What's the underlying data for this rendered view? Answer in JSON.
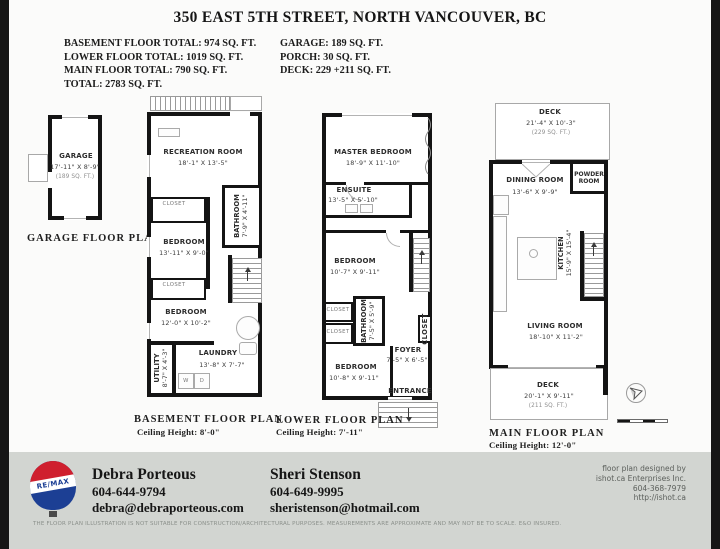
{
  "header": {
    "title": "350 EAST 5TH STREET, NORTH VANCOUVER, BC",
    "summary_left": [
      "BASEMENT FLOOR TOTAL: 974 SQ. FT.",
      "LOWER FLOOR TOTAL: 1019 SQ. FT.",
      "MAIN FLOOR TOTAL: 790 SQ. FT.",
      "TOTAL: 2783 SQ. FT."
    ],
    "summary_right": [
      "GARAGE: 189 SQ. FT.",
      "PORCH: 30 SQ. FT.",
      "DECK: 229 +211 SQ. FT."
    ]
  },
  "garage_plan": {
    "caption": "GARAGE FLOOR PLAN",
    "room": {
      "name": "GARAGE",
      "dims": "17'-11\" X 8'-9\"",
      "area": "(189 SQ. FT.)"
    }
  },
  "basement_plan": {
    "caption": "BASEMENT FLOOR PLAN",
    "ceiling": "Ceiling Height: 8'-0\"",
    "rooms": {
      "recreation": {
        "name": "RECREATION ROOM",
        "dims": "18'-1\" X 13'-5\""
      },
      "bathroom": {
        "name": "BATHROOM",
        "dims": "7'-9\" X 4'-11\""
      },
      "closet1": {
        "name": "CLOSET"
      },
      "bedroom1": {
        "name": "BEDROOM",
        "dims": "13'-11\" X 9'-0\""
      },
      "closet2": {
        "name": "CLOSET"
      },
      "bedroom2": {
        "name": "BEDROOM",
        "dims": "12'-0\" X 10'-2\""
      },
      "utility": {
        "name": "UTILITY",
        "dims": "8'-7\" X 4'-3\""
      },
      "laundry": {
        "name": "LAUNDRY",
        "dims": "13'-8\" X 7'-7\""
      }
    },
    "appliances": {
      "washer": "W",
      "dryer": "D"
    }
  },
  "lower_plan": {
    "caption": "LOWER FLOOR PLAN",
    "ceiling": "Ceiling Height: 7'-11\"",
    "rooms": {
      "master": {
        "name": "MASTER BEDROOM",
        "dims": "18'-9\" X 11'-10\""
      },
      "ensuite": {
        "name": "ENSUITE",
        "dims": "13'-5\" X 5'-10\""
      },
      "bedroom1": {
        "name": "BEDROOM",
        "dims": "10'-7\" X 9'-11\""
      },
      "closet1": {
        "name": "CLOSET"
      },
      "closet2": {
        "name": "CLOSET"
      },
      "bathroom": {
        "name": "BATHROOM",
        "dims": "7'-5\" X 5'-9\""
      },
      "closet3": {
        "name": "CLOSET"
      },
      "foyer": {
        "name": "FOYER",
        "dims": "7'-5\" X 6'-5\""
      },
      "bedroom2": {
        "name": "BEDROOM",
        "dims": "10'-8\" X 9'-11\""
      },
      "entrance": {
        "name": "ENTRANCE"
      }
    }
  },
  "main_plan": {
    "caption": "MAIN FLOOR PLAN",
    "ceiling": "Ceiling Height: 12'-0\"",
    "rooms": {
      "deck_top": {
        "name": "DECK",
        "dims": "21'-4\" X 10'-3\"",
        "area": "(229 SQ. FT.)"
      },
      "dining": {
        "name": "DINING ROOM",
        "dims": "13'-6\" X 9'-9\""
      },
      "powder": {
        "name": "POWDER ROOM"
      },
      "kitchen": {
        "name": "KITCHEN",
        "dims": "15'-9\" X 15'-4\""
      },
      "living": {
        "name": "LIVING ROOM",
        "dims": "18'-10\" X 11'-2\""
      },
      "deck_bottom": {
        "name": "DECK",
        "dims": "20'-1\" X 9'-11\"",
        "area": "(211 SQ. FT.)"
      }
    }
  },
  "footer": {
    "brand": "RE/MAX",
    "agents": [
      {
        "name": "Debra Porteous",
        "phone": "604-644-9794",
        "email": "debra@debraporteous.com"
      },
      {
        "name": "Sheri Stenson",
        "phone": "604-649-9995",
        "email": "sheristenson@hotmail.com"
      }
    ],
    "designer": [
      "floor plan designed by",
      "ishot.ca Enterprises Inc.",
      "604-368-7979",
      "http://ishot.ca"
    ],
    "disclaimer": "THE FLOOR PLAN ILLUSTRATION IS NOT SUITABLE FOR CONSTRUCTION/ARCHITECTURAL PURPOSES. MEASUREMENTS ARE APPROXIMATE AND MAY NOT BE TO SCALE. E&O INSURED."
  },
  "colors": {
    "wall": "#141414",
    "footer_bg": "#d2d5d1",
    "remax_red": "#cf1f2e",
    "remax_blue": "#1c3f94"
  }
}
